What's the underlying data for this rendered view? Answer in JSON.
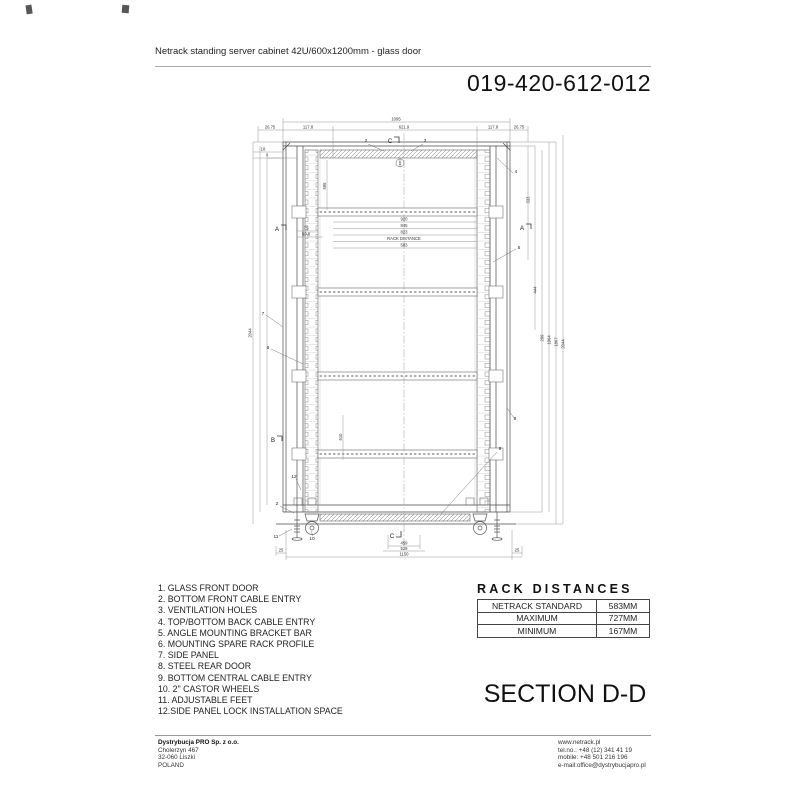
{
  "header": {
    "title": "Netrack standing server cabinet 42U/600x1200mm - glass door",
    "part_number": "019-420-612-012"
  },
  "parts_list": {
    "items": [
      "1. GLASS FRONT DOOR",
      "2. BOTTOM FRONT CABLE ENTRY",
      "3. VENTILATION HOLES",
      "4. TOP/BOTTOM BACK CABLE ENTRY",
      "5. ANGLE MOUNTING BRACKET BAR",
      "6. MOUNTING SPARE RACK PROFILE",
      "7. SIDE PANEL",
      "8. STEEL REAR DOOR",
      "9. BOTTOM CENTRAL CABLE ENTRY",
      "10. 2\" CASTOR WHEELS",
      "11. ADJUSTABLE FEET",
      "12.SIDE PANEL LOCK INSTALLATION SPACE"
    ]
  },
  "rack_distances": {
    "title": "RACK DISTANCES",
    "rows": [
      {
        "label": "NETRACK STANDARD",
        "value": "583MM"
      },
      {
        "label": "MAXIMUM",
        "value": "727MM"
      },
      {
        "label": "MINIMUM",
        "value": "167MM"
      }
    ]
  },
  "section_title": "SECTION D-D",
  "footer": {
    "company": "Dystrybucja PRO Sp. z o.o.",
    "address_lines": [
      "Cholerzyn 467",
      "32-060 Liszki",
      "POLAND"
    ],
    "contact_lines": [
      "www.netrack.pl",
      "tel.no.: +48 (12) 341 41 19",
      "mobile: +48 501 216 196",
      "e-mail:office@dystrybucjapro.pl"
    ]
  },
  "drawing": {
    "dim_labels": [
      {
        "t": "1095",
        "x": 396,
        "y": 120.5
      },
      {
        "t": "26.75",
        "x": 270,
        "y": 128.5
      },
      {
        "t": "117.8",
        "x": 308,
        "y": 128.5
      },
      {
        "t": "621.9",
        "x": 404,
        "y": 128.5
      },
      {
        "t": "117.8",
        "x": 493,
        "y": 128.5
      },
      {
        "t": "26.75",
        "x": 519,
        "y": 128.5
      },
      {
        "t": "18",
        "x": 263,
        "y": 150.5
      },
      {
        "t": "9",
        "x": 267,
        "y": 156.5
      },
      {
        "t": "595",
        "x": 326,
        "y": 186,
        "r": 1
      },
      {
        "t": "75",
        "x": 306,
        "y": 229.5
      },
      {
        "t": "50.8",
        "x": 306,
        "y": 235.5
      },
      {
        "t": "920",
        "x": 404,
        "y": 220.5
      },
      {
        "t": "845",
        "x": 404,
        "y": 227
      },
      {
        "t": "823",
        "x": 404,
        "y": 233.5
      },
      {
        "t": "RACK DISTANCE",
        "x": 404,
        "y": 240
      },
      {
        "t": "583",
        "x": 404,
        "y": 246.5
      },
      {
        "t": "610",
        "x": 342,
        "y": 437,
        "r": 1
      },
      {
        "t": "2044",
        "x": 251.5,
        "y": 333,
        "r": 1
      },
      {
        "t": "333",
        "x": 529.5,
        "y": 200,
        "r": 1
      },
      {
        "t": "444",
        "x": 536.5,
        "y": 290,
        "r": 1
      },
      {
        "t": "299",
        "x": 543.5,
        "y": 338,
        "r": 1
      },
      {
        "t": "1964",
        "x": 550.5,
        "y": 340,
        "r": 1
      },
      {
        "t": "1867",
        "x": 557.5,
        "y": 342,
        "r": 1
      },
      {
        "t": "2044",
        "x": 564.5,
        "y": 344,
        "r": 1
      },
      {
        "t": "459",
        "x": 404,
        "y": 544.5
      },
      {
        "t": "529",
        "x": 404,
        "y": 550
      },
      {
        "t": "1150",
        "x": 404,
        "y": 555.5
      },
      {
        "t": "25",
        "x": 281,
        "y": 551.5
      },
      {
        "t": "25",
        "x": 517,
        "y": 551.5
      }
    ],
    "callouts": [
      {
        "t": "2",
        "x": 366,
        "y": 142
      },
      {
        "t": "3",
        "x": 425,
        "y": 142
      },
      {
        "t": "1",
        "x": 400,
        "y": 164.5,
        "c": 1
      },
      {
        "t": "4",
        "x": 516,
        "y": 173
      },
      {
        "t": "5",
        "x": 519,
        "y": 249
      },
      {
        "t": "7",
        "x": 263,
        "y": 315
      },
      {
        "t": "6",
        "x": 268,
        "y": 349
      },
      {
        "t": "8",
        "x": 515,
        "y": 420
      },
      {
        "t": "12",
        "x": 294,
        "y": 478
      },
      {
        "t": "2",
        "x": 277,
        "y": 505
      },
      {
        "t": "9",
        "x": 500,
        "y": 450
      },
      {
        "t": "11",
        "x": 276,
        "y": 538
      },
      {
        "t": "10",
        "x": 312,
        "y": 540
      }
    ],
    "section_markers": [
      {
        "t": "C",
        "x": 390,
        "y": 143
      },
      {
        "t": "A",
        "x": 277,
        "y": 231
      },
      {
        "t": "A",
        "x": 522,
        "y": 230
      },
      {
        "t": "B",
        "x": 273,
        "y": 442
      },
      {
        "t": "C",
        "x": 392,
        "y": 538
      }
    ]
  }
}
